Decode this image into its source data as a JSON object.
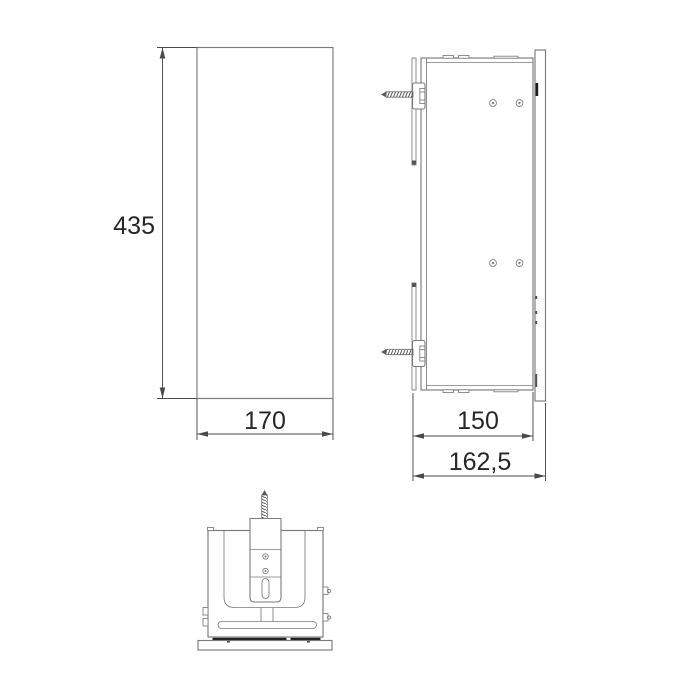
{
  "drawing": {
    "front_view": {
      "height_label": "435",
      "width_label": "170"
    },
    "side_view": {
      "depth_label": "150",
      "total_depth_label": "162,5"
    },
    "colors": {
      "outline": "#7b7b7b",
      "dimension": "#4a4a4a",
      "text": "#262626",
      "accent_dark": "#1e1e1e",
      "background": "#ffffff"
    }
  }
}
